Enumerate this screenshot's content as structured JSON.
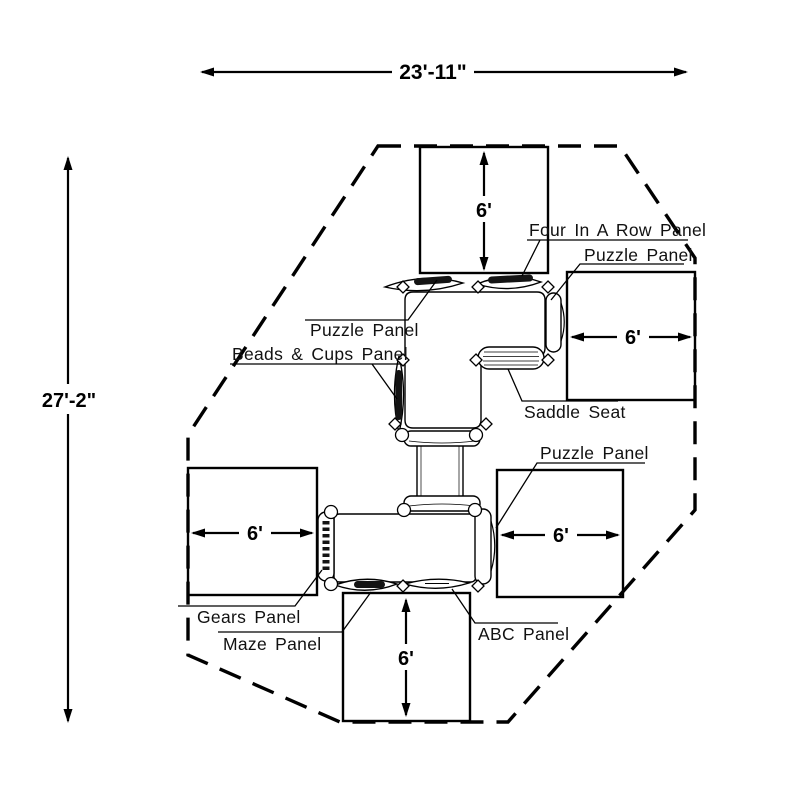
{
  "page": {
    "title": "Playground structure plan view",
    "background_color": "#ffffff",
    "line_color": "#000000"
  },
  "dimensions": {
    "overall_width": "23'-11\"",
    "overall_height": "27'-2\"",
    "clearances": {
      "top": "6'",
      "right": "6'",
      "left": "6'",
      "bottom": "6'",
      "bottom_right": "6'"
    }
  },
  "labels": {
    "four_in_a_row": "Four In A Row Panel",
    "puzzle_top_right": "Puzzle Panel",
    "puzzle_top_left": "Puzzle Panel",
    "beads_cups": "Beads & Cups Panel",
    "saddle_seat": "Saddle Seat",
    "puzzle_bottom_right": "Puzzle Panel",
    "gears": "Gears Panel",
    "maze": "Maze Panel",
    "abc": "ABC Panel"
  }
}
